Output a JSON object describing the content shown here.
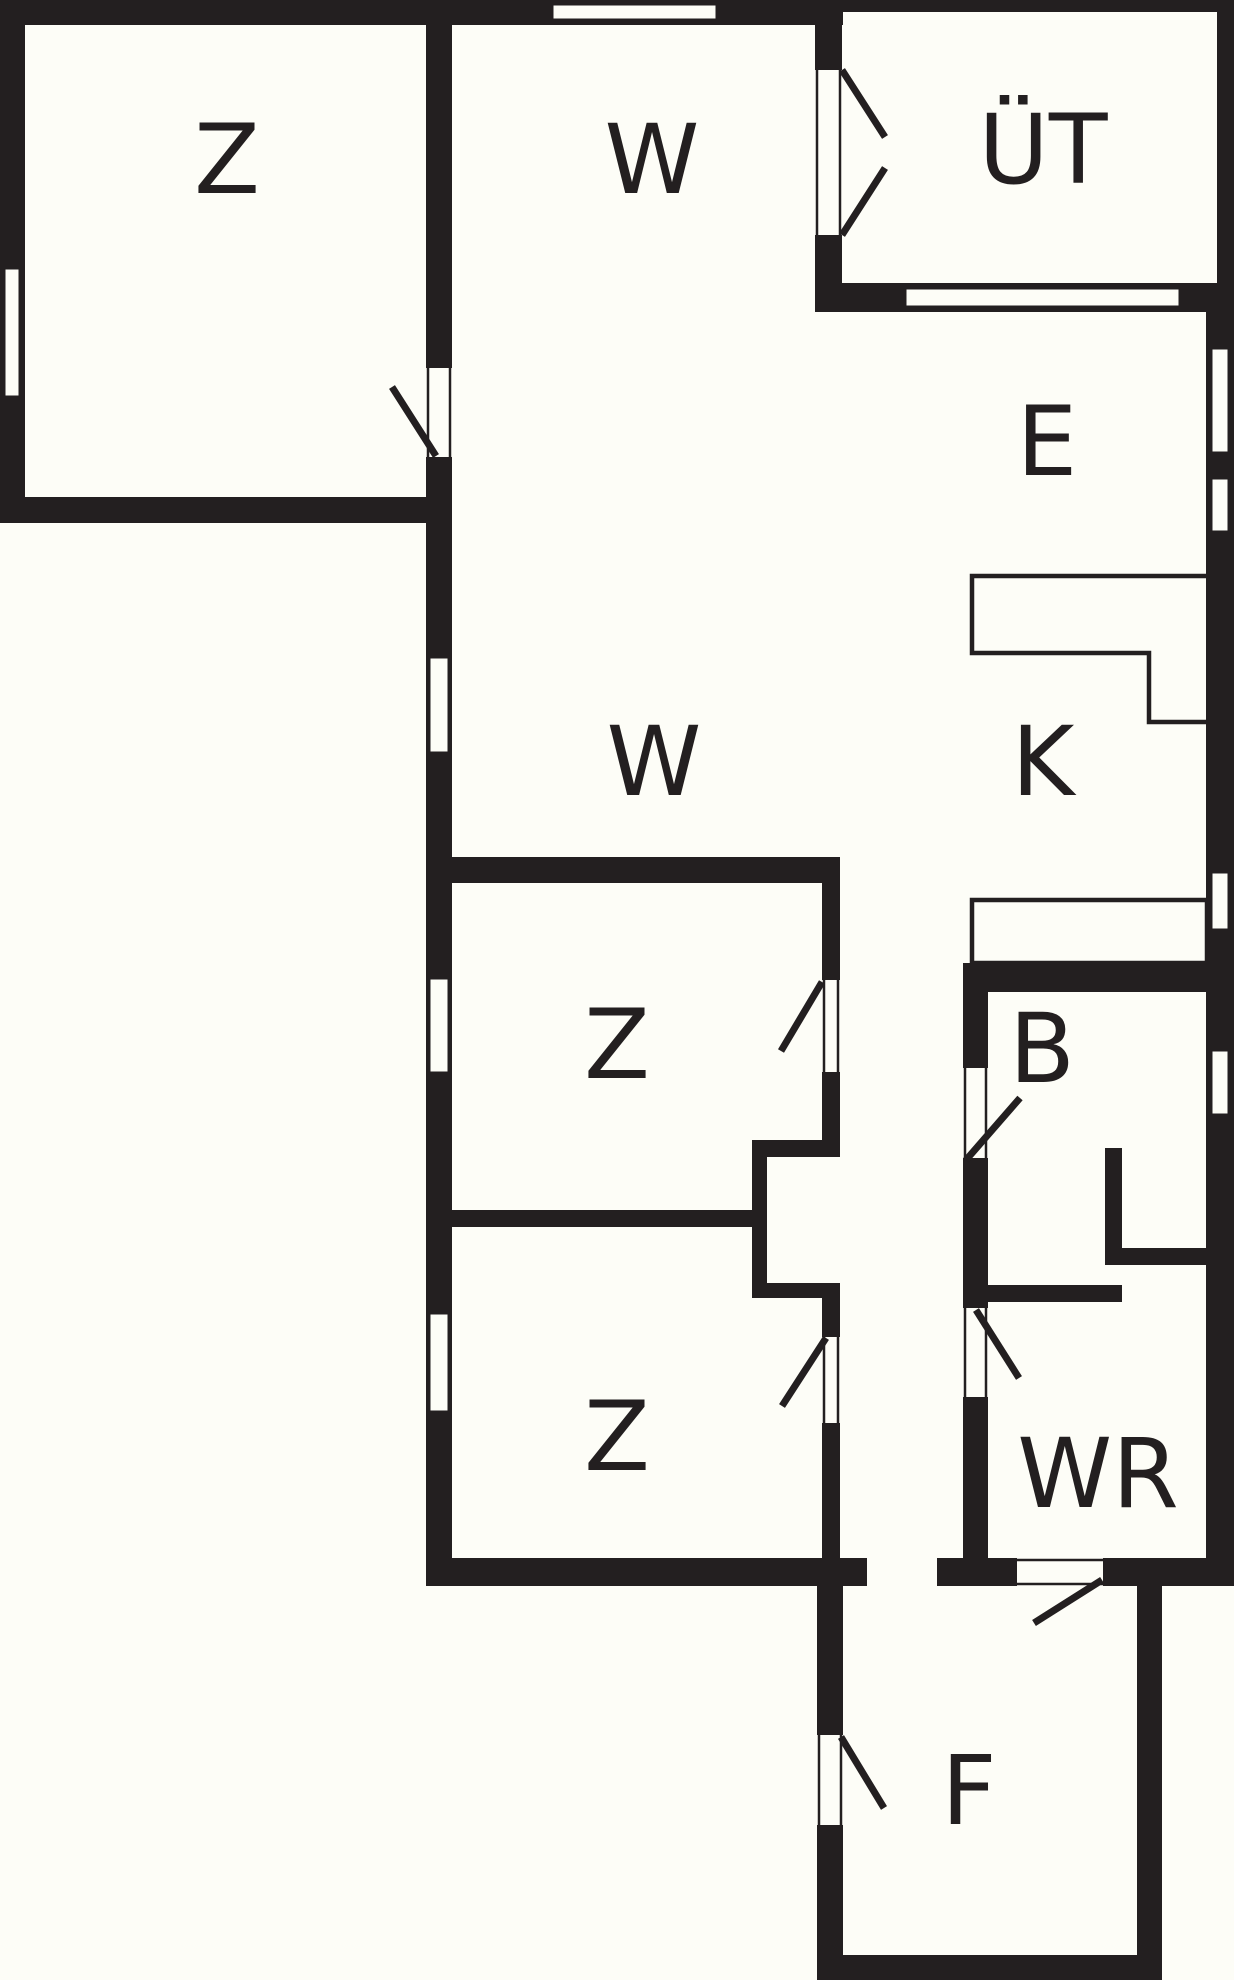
{
  "plan": {
    "title": "floor-plan",
    "canvas": {
      "width": 1234,
      "height": 1980
    },
    "colors": {
      "background": "#FDFDF7",
      "wall": "#231F20",
      "label": "#231F20",
      "window_fill": "#FDFDF7"
    },
    "label_font_size": 96,
    "rooms": [
      {
        "id": "z-top-left",
        "label": "Z",
        "cx": 227,
        "cy": 160
      },
      {
        "id": "w-top",
        "label": "W",
        "cx": 652,
        "cy": 160
      },
      {
        "id": "ut-porch",
        "label": "ÜT",
        "cx": 1043,
        "cy": 150
      },
      {
        "id": "e-entry",
        "label": "E",
        "cx": 1047,
        "cy": 442
      },
      {
        "id": "w-hall",
        "label": "W",
        "cx": 654,
        "cy": 762
      },
      {
        "id": "k-kitchen",
        "label": "K",
        "cx": 1043,
        "cy": 762
      },
      {
        "id": "z-middle",
        "label": "Z",
        "cx": 617,
        "cy": 1045
      },
      {
        "id": "b-bath",
        "label": "B",
        "cx": 1042,
        "cy": 1049
      },
      {
        "id": "z-lower",
        "label": "Z",
        "cx": 617,
        "cy": 1437
      },
      {
        "id": "wr-room",
        "label": "WR",
        "cx": 1098,
        "cy": 1474
      },
      {
        "id": "f-room",
        "label": "F",
        "cx": 969,
        "cy": 1791
      }
    ],
    "walls": [
      {
        "name": "outer-top-main",
        "x": 0,
        "y": 0,
        "w": 843,
        "h": 25
      },
      {
        "name": "ut-top-thin",
        "x": 843,
        "y": 0,
        "w": 391,
        "h": 12
      },
      {
        "name": "ut-right-thin",
        "x": 1217,
        "y": 12,
        "w": 17,
        "h": 271
      },
      {
        "name": "outer-left",
        "x": 0,
        "y": 0,
        "w": 25,
        "h": 523
      },
      {
        "name": "z1-bottom",
        "x": 0,
        "y": 497,
        "w": 452,
        "h": 26
      },
      {
        "name": "hall-left-upper",
        "x": 426,
        "y": 25,
        "w": 26,
        "h": 343
      },
      {
        "name": "hall-left-lower",
        "x": 426,
        "y": 457,
        "w": 26,
        "h": 1129
      },
      {
        "name": "w-ut-stub-upper",
        "x": 815,
        "y": 25,
        "w": 27,
        "h": 45
      },
      {
        "name": "w-ut-stub-lower",
        "x": 815,
        "y": 235,
        "w": 27,
        "h": 48
      },
      {
        "name": "ut-bottom",
        "x": 815,
        "y": 283,
        "w": 419,
        "h": 29
      },
      {
        "name": "outer-right",
        "x": 1206,
        "y": 312,
        "w": 28,
        "h": 1274
      },
      {
        "name": "bottom-left",
        "x": 426,
        "y": 1558,
        "w": 441,
        "h": 28
      },
      {
        "name": "bottom-right-a",
        "x": 937,
        "y": 1558,
        "w": 80,
        "h": 28
      },
      {
        "name": "bottom-right-b",
        "x": 1103,
        "y": 1558,
        "w": 107,
        "h": 28
      },
      {
        "name": "f-left-upper",
        "x": 817,
        "y": 1586,
        "w": 26,
        "h": 149
      },
      {
        "name": "f-left-lower",
        "x": 817,
        "y": 1825,
        "w": 26,
        "h": 155
      },
      {
        "name": "f-bottom",
        "x": 817,
        "y": 1955,
        "w": 345,
        "h": 25
      },
      {
        "name": "f-right",
        "x": 1137,
        "y": 1558,
        "w": 25,
        "h": 422
      },
      {
        "name": "z2-top",
        "x": 426,
        "y": 857,
        "w": 414,
        "h": 26
      },
      {
        "name": "z2-right-upper",
        "x": 822,
        "y": 883,
        "w": 18,
        "h": 97
      },
      {
        "name": "z2-right-lower",
        "x": 822,
        "y": 1072,
        "w": 18,
        "h": 85
      },
      {
        "name": "alcove-top",
        "x": 752,
        "y": 1140,
        "w": 88,
        "h": 17
      },
      {
        "name": "alcove-left",
        "x": 752,
        "y": 1140,
        "w": 15,
        "h": 158
      },
      {
        "name": "alcove-bottom",
        "x": 752,
        "y": 1283,
        "w": 88,
        "h": 15
      },
      {
        "name": "z3-right-stub",
        "x": 822,
        "y": 1298,
        "w": 18,
        "h": 39
      },
      {
        "name": "z3-right-lower",
        "x": 822,
        "y": 1423,
        "w": 18,
        "h": 137
      },
      {
        "name": "z3-top",
        "x": 426,
        "y": 1210,
        "w": 341,
        "h": 17
      },
      {
        "name": "b-top",
        "x": 963,
        "y": 963,
        "w": 243,
        "h": 29
      },
      {
        "name": "b-left-upper",
        "x": 963,
        "y": 992,
        "w": 25,
        "h": 76
      },
      {
        "name": "b-left-lower",
        "x": 963,
        "y": 1158,
        "w": 25,
        "h": 150
      },
      {
        "name": "wr-left",
        "x": 963,
        "y": 1397,
        "w": 25,
        "h": 171
      },
      {
        "name": "b-inner-vert",
        "x": 1105,
        "y": 1148,
        "w": 17,
        "h": 117
      },
      {
        "name": "b-inner-horiz",
        "x": 1122,
        "y": 1248,
        "w": 84,
        "h": 17
      },
      {
        "name": "b-bottom",
        "x": 982,
        "y": 1285,
        "w": 140,
        "h": 17
      }
    ],
    "windows": [
      {
        "name": "window-top",
        "x": 552,
        "y": 4,
        "w": 165,
        "h": 16
      },
      {
        "name": "window-left",
        "x": 4,
        "y": 268,
        "w": 16,
        "h": 129
      },
      {
        "name": "window-ut-south",
        "x": 905,
        "y": 288,
        "w": 275,
        "h": 19
      },
      {
        "name": "window-right-1",
        "x": 1211,
        "y": 348,
        "w": 18,
        "h": 105
      },
      {
        "name": "window-right-2",
        "x": 1211,
        "y": 478,
        "w": 18,
        "h": 54
      },
      {
        "name": "window-right-3",
        "x": 1211,
        "y": 872,
        "w": 18,
        "h": 58
      },
      {
        "name": "window-right-4",
        "x": 1211,
        "y": 1050,
        "w": 18,
        "h": 65
      },
      {
        "name": "window-hall-1",
        "x": 429,
        "y": 657,
        "w": 20,
        "h": 96
      },
      {
        "name": "window-hall-2",
        "x": 429,
        "y": 978,
        "w": 20,
        "h": 95
      },
      {
        "name": "window-hall-3",
        "x": 429,
        "y": 1313,
        "w": 20,
        "h": 99
      }
    ],
    "doors": [
      {
        "name": "door-z-top-left",
        "frames": [
          [
            428,
            368,
            428,
            457
          ],
          [
            450,
            368,
            450,
            457
          ]
        ],
        "leaves": [
          [
            436,
            456,
            392,
            387
          ]
        ]
      },
      {
        "name": "door-ut-double",
        "frames": [
          [
            817,
            70,
            817,
            235
          ],
          [
            840,
            70,
            840,
            235
          ]
        ],
        "leaves": [
          [
            842,
            70,
            885,
            137
          ],
          [
            842,
            235,
            885,
            168
          ]
        ]
      },
      {
        "name": "door-z-middle",
        "frames": [
          [
            824,
            980,
            824,
            1072
          ],
          [
            838,
            980,
            838,
            1072
          ]
        ],
        "leaves": [
          [
            822,
            982,
            781,
            1051
          ]
        ]
      },
      {
        "name": "door-b",
        "frames": [
          [
            965,
            1068,
            965,
            1158
          ],
          [
            986,
            1068,
            986,
            1158
          ]
        ],
        "leaves": [
          [
            966,
            1160,
            1020,
            1098
          ]
        ]
      },
      {
        "name": "door-z-lower",
        "frames": [
          [
            824,
            1337,
            824,
            1423
          ],
          [
            838,
            1337,
            838,
            1423
          ]
        ],
        "leaves": [
          [
            826,
            1338,
            782,
            1406
          ]
        ]
      },
      {
        "name": "door-wr",
        "frames": [
          [
            965,
            1308,
            965,
            1397
          ],
          [
            986,
            1308,
            986,
            1397
          ]
        ],
        "leaves": [
          [
            976,
            1310,
            1019,
            1378
          ]
        ]
      },
      {
        "name": "door-f",
        "frames": [
          [
            819,
            1735,
            819,
            1825
          ],
          [
            841,
            1735,
            841,
            1825
          ]
        ],
        "leaves": [
          [
            841,
            1737,
            884,
            1808
          ]
        ]
      },
      {
        "name": "door-wr-f",
        "frames": [
          [
            1017,
            1560,
            1103,
            1560
          ],
          [
            1017,
            1584,
            1103,
            1584
          ]
        ],
        "leaves": [
          [
            1102,
            1580,
            1034,
            1623
          ]
        ]
      }
    ],
    "fixtures": [
      {
        "name": "kitchen-counter-k",
        "type": "path",
        "d": "M 1206 576 L 972 576 L 972 653 L 1149 653 L 1149 722 L 1206 722"
      },
      {
        "name": "kitchen-counter-b",
        "type": "rect",
        "x": 972,
        "y": 900,
        "w": 235,
        "h": 63
      }
    ],
    "stroke": {
      "window_outline": 3,
      "door_frame": 2.5,
      "door_leaf": 7,
      "fixture": 4.5
    }
  }
}
